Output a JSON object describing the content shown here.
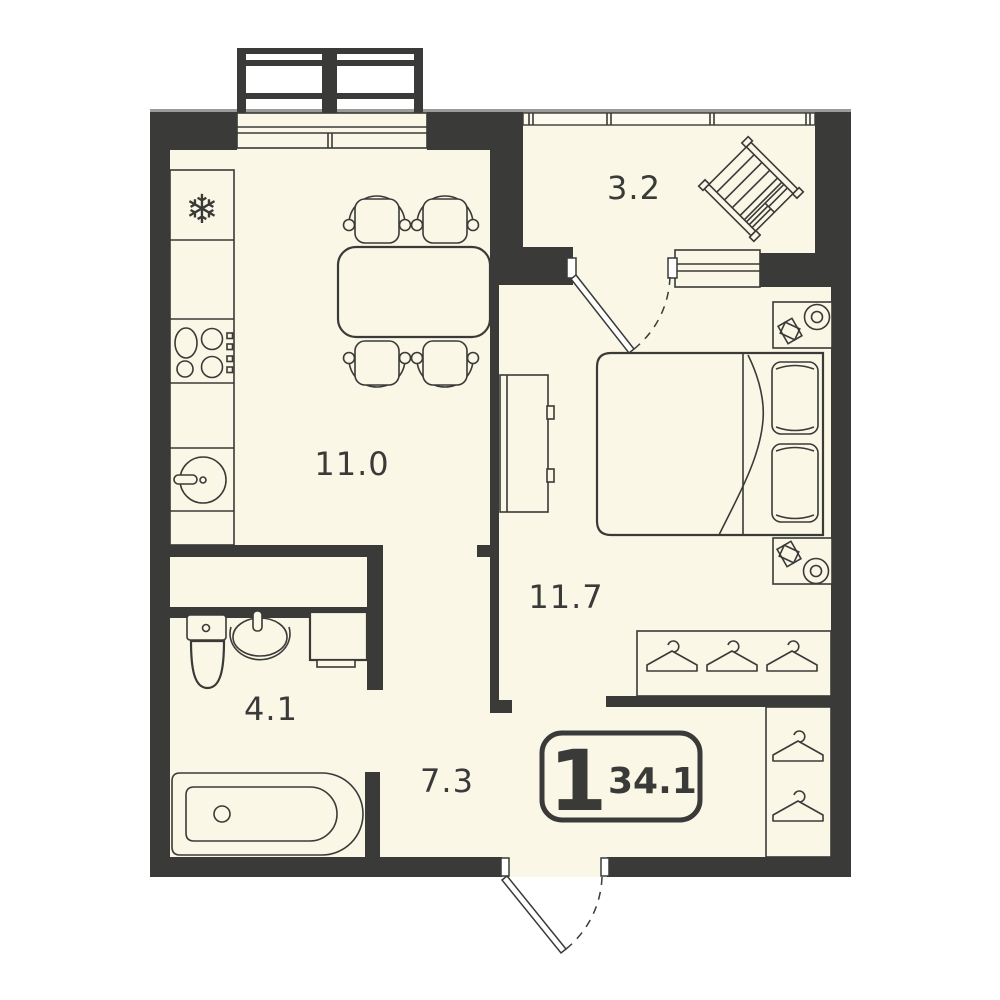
{
  "plan": {
    "type": "apartment-floor-plan",
    "unit_badge": {
      "rooms_count": "1",
      "total_area": "34.1"
    },
    "rooms": [
      {
        "id": "kitchen-living",
        "area_label": "11.0"
      },
      {
        "id": "balcony",
        "area_label": "3.2"
      },
      {
        "id": "bedroom",
        "area_label": "11.7"
      },
      {
        "id": "bathroom",
        "area_label": "4.1"
      },
      {
        "id": "hallway",
        "area_label": "7.3"
      }
    ],
    "icons": {
      "fridge_snowflake": "❄"
    },
    "colors": {
      "wall": "#3A3A38",
      "floor": "#FAF7E7",
      "background": "#FFFFFF",
      "glass": "#FDFBF0",
      "cap": "#9B9B99",
      "door_white": "#FFFFFF"
    }
  }
}
